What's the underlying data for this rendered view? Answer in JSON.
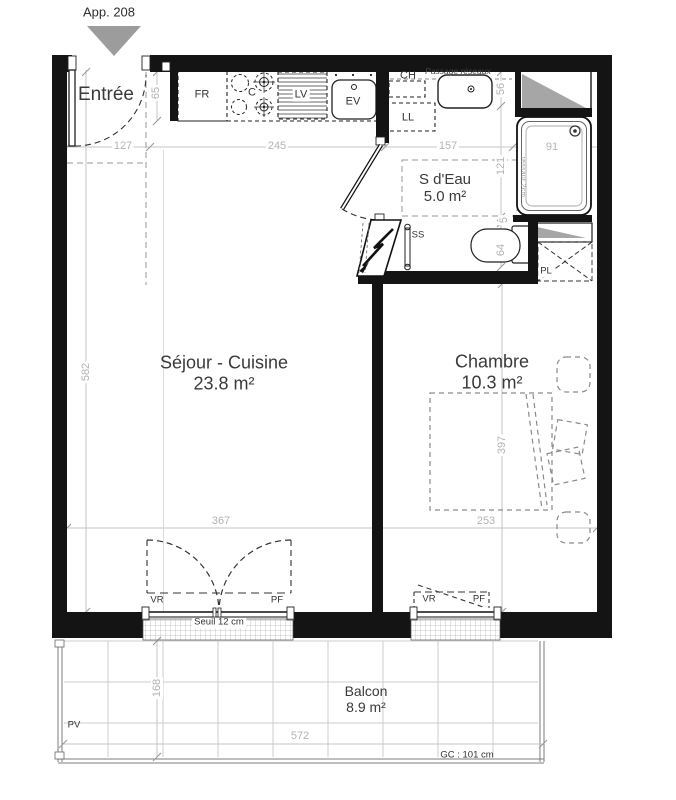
{
  "header": {
    "apartment": "App. 208"
  },
  "rooms": {
    "entree": {
      "name": "Entrée"
    },
    "sejour": {
      "name": "Séjour - Cuisine",
      "area": "23.8 m²"
    },
    "sdeau": {
      "name": "S d'Eau",
      "area": "5.0 m²"
    },
    "chambre": {
      "name": "Chambre",
      "area": "10.3 m²"
    },
    "balcon": {
      "name": "Balcon",
      "area": "8.9 m²"
    }
  },
  "equipment": {
    "fr": "FR",
    "c": "C",
    "lv": "LV",
    "ev": "EV",
    "ch": "CH",
    "ll": "LL",
    "ss": "SS",
    "pl": "PL",
    "vr": "VR",
    "pf": "PF",
    "pv": "PV"
  },
  "annotations": {
    "passage_reseaux": "Passage réseaux",
    "seuil": "Seuil 12 cm",
    "gc": "GC : 101 cm",
    "ressaut": "ressaut 2cm"
  },
  "dimensions": {
    "top": [
      "127",
      "245",
      "157",
      "91"
    ],
    "entry_depth": "65",
    "right": [
      "56",
      "121",
      "5",
      "64"
    ],
    "left_total": "582",
    "chambre_height": "397",
    "sejour_width": "367",
    "chambre_width": "253",
    "balcony_depth": "168",
    "balcony_width": "572"
  },
  "colors": {
    "wall": "#141414",
    "dimension": "#b3b3b3",
    "label": "#3a3a3a",
    "duct_triangle": "#a6a6a6",
    "balcony_grid": "#cccccc"
  }
}
